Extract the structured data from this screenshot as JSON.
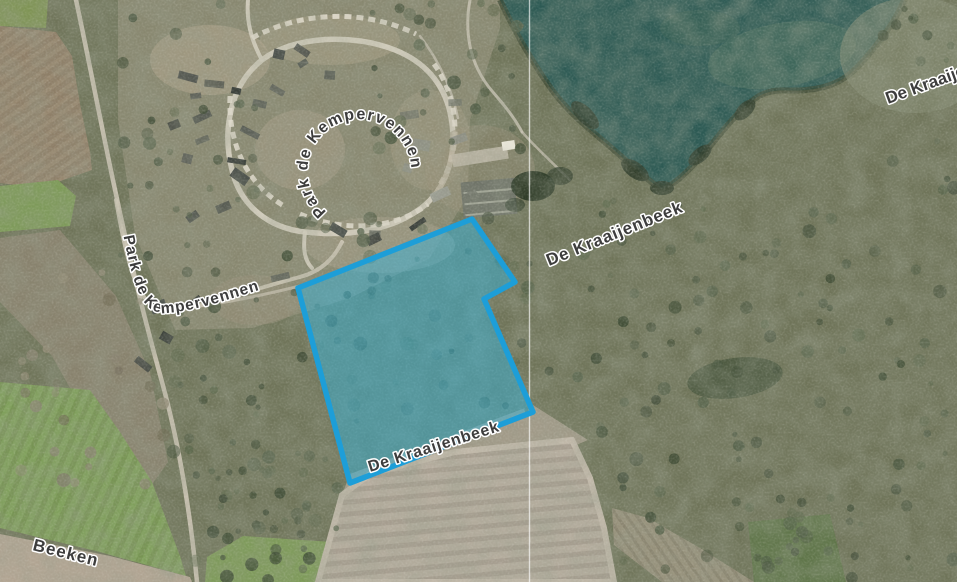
{
  "map": {
    "labels": {
      "park_loop": "Park de Kempervennen",
      "park_road": "Park de Kempervennen",
      "kraaijenbeek_upper": "De Kraaijenbeek",
      "kraaijenbeek_lower": "De Kraaijenbeek",
      "kraaijenbeek_edge": "De Kraaijenbeek",
      "beeken": "Beeken"
    },
    "selection": {
      "stroke_color": "#1d9ed8",
      "fill_color": "rgba(52,180,219,0.48)"
    }
  }
}
